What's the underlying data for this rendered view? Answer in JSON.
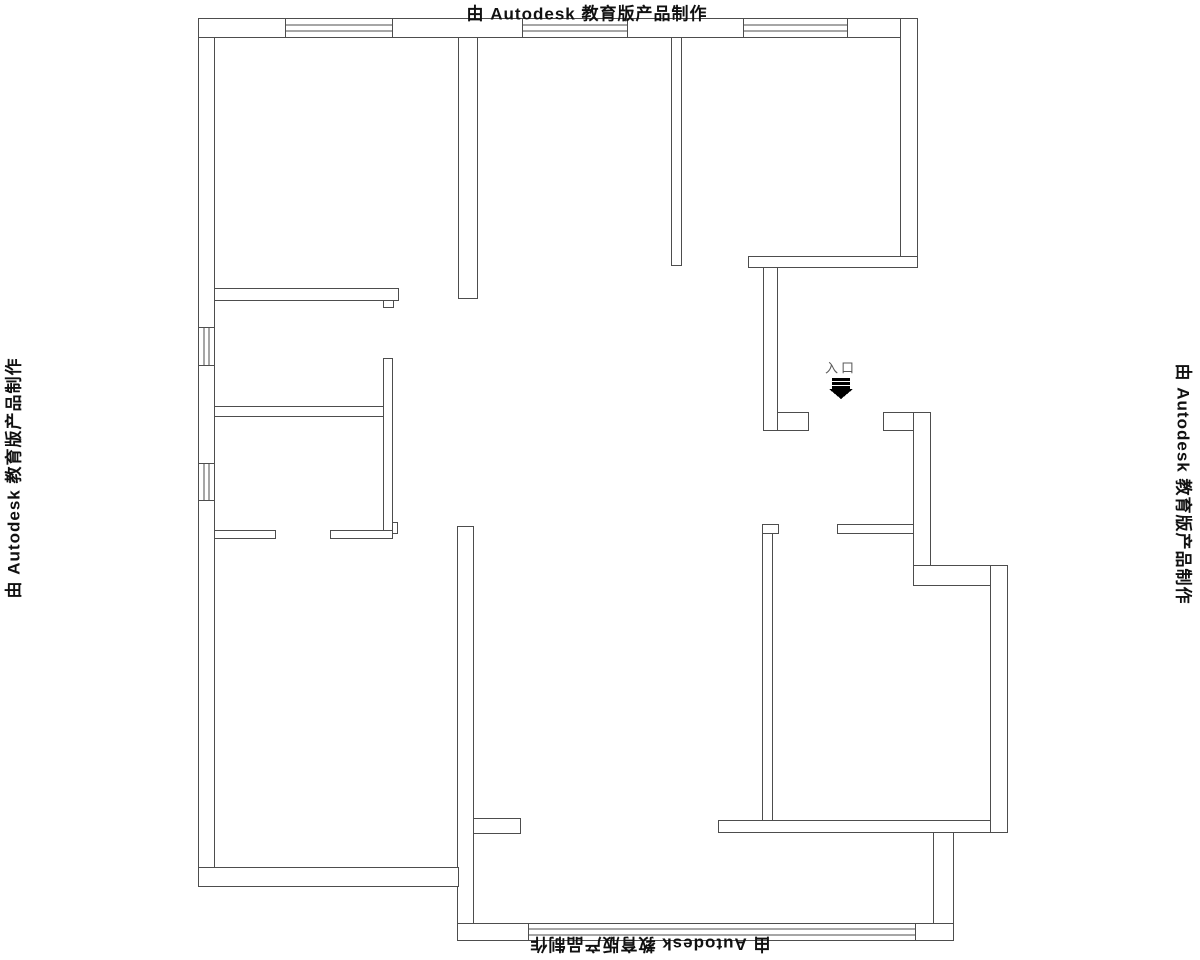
{
  "watermark": {
    "text": "由 Autodesk 教育版产品制作"
  },
  "entrance": {
    "label": "入口"
  },
  "drawing": {
    "line_color": "#4d4d4d",
    "wall_fill": "#ffffff",
    "arrow_color": "#000000",
    "walls": [
      {
        "name": "exterior-left-wall",
        "x": 198,
        "y": 18,
        "w": 16,
        "h": 868
      },
      {
        "name": "exterior-top-wall",
        "x": 198,
        "y": 18,
        "w": 719,
        "h": 19
      },
      {
        "name": "exterior-right-wall-upper",
        "x": 900,
        "y": 18,
        "w": 17,
        "h": 249
      },
      {
        "name": "topright-room-bottom-wall",
        "x": 748,
        "y": 256,
        "w": 169,
        "h": 11
      },
      {
        "name": "porch-left-wall",
        "x": 763,
        "y": 267,
        "w": 14,
        "h": 163
      },
      {
        "name": "porch-left-wall-foot",
        "x": 777,
        "y": 412,
        "w": 31,
        "h": 18
      },
      {
        "name": "porch-right-wall",
        "x": 883,
        "y": 412,
        "w": 47,
        "h": 18
      },
      {
        "name": "exterior-right-wall-mid",
        "x": 913,
        "y": 412,
        "w": 17,
        "h": 153
      },
      {
        "name": "exterior-right-step",
        "x": 913,
        "y": 565,
        "w": 94,
        "h": 20
      },
      {
        "name": "exterior-right-wall-lower",
        "x": 990,
        "y": 565,
        "w": 17,
        "h": 267
      },
      {
        "name": "bottomright-room-bottom-wall",
        "x": 718,
        "y": 820,
        "w": 272,
        "h": 12
      },
      {
        "name": "balcony-right-column",
        "x": 933,
        "y": 832,
        "w": 20,
        "h": 108
      },
      {
        "name": "balcony-left-wall",
        "x": 457,
        "y": 526,
        "w": 16,
        "h": 414
      },
      {
        "name": "balcony-left-stub",
        "x": 473,
        "y": 818,
        "w": 47,
        "h": 15
      },
      {
        "name": "exterior-bottom-wall-left",
        "x": 198,
        "y": 867,
        "w": 260,
        "h": 19
      },
      {
        "name": "balcony-bottom-wall",
        "x": 457,
        "y": 923,
        "w": 496,
        "h": 17
      },
      {
        "name": "topleft-room-right-wall",
        "x": 458,
        "y": 37,
        "w": 19,
        "h": 261
      },
      {
        "name": "topleft-room-bottom-wall",
        "x": 214,
        "y": 288,
        "w": 184,
        "h": 12
      },
      {
        "name": "topleft-room-bottom-notch",
        "x": 383,
        "y": 300,
        "w": 10,
        "h": 7
      },
      {
        "name": "topmid-topright-partition",
        "x": 671,
        "y": 37,
        "w": 10,
        "h": 228
      },
      {
        "name": "left-rooms-divider-wall",
        "x": 214,
        "y": 406,
        "w": 169,
        "h": 10
      },
      {
        "name": "left-vertical-wall",
        "x": 383,
        "y": 358,
        "w": 9,
        "h": 175
      },
      {
        "name": "left-vertical-wall-foot",
        "x": 392,
        "y": 522,
        "w": 5,
        "h": 11
      },
      {
        "name": "left-rooms-bottom-wall-a",
        "x": 214,
        "y": 530,
        "w": 61,
        "h": 8
      },
      {
        "name": "left-rooms-bottom-wall-b",
        "x": 330,
        "y": 530,
        "w": 62,
        "h": 8
      },
      {
        "name": "bottomright-room-top-wall",
        "x": 837,
        "y": 524,
        "w": 76,
        "h": 9
      },
      {
        "name": "bottomright-room-left-wall",
        "x": 762,
        "y": 524,
        "w": 10,
        "h": 296
      },
      {
        "name": "bottomright-room-left-head",
        "x": 762,
        "y": 524,
        "w": 16,
        "h": 9
      }
    ],
    "windows": [
      {
        "name": "window-top-left",
        "x": 285,
        "y": 18,
        "w": 107,
        "h": 19,
        "orient": "h"
      },
      {
        "name": "window-top-middle",
        "x": 522,
        "y": 18,
        "w": 105,
        "h": 19,
        "orient": "h"
      },
      {
        "name": "window-top-right",
        "x": 743,
        "y": 18,
        "w": 104,
        "h": 19,
        "orient": "h"
      },
      {
        "name": "window-left-upper",
        "x": 198,
        "y": 327,
        "w": 16,
        "h": 38,
        "orient": "v"
      },
      {
        "name": "window-left-lower",
        "x": 198,
        "y": 463,
        "w": 16,
        "h": 37,
        "orient": "v"
      },
      {
        "name": "window-balcony",
        "x": 528,
        "y": 923,
        "w": 387,
        "h": 17,
        "orient": "h"
      }
    ],
    "entrance_arrow": {
      "bars": [
        {
          "x": 832,
          "y": 378,
          "w": 18,
          "h": 3
        },
        {
          "x": 832,
          "y": 382,
          "w": 18,
          "h": 3
        },
        {
          "x": 832,
          "y": 386,
          "w": 18,
          "h": 3
        }
      ],
      "triangle": [
        [
          829,
          389
        ],
        [
          853,
          389
        ],
        [
          841,
          399
        ]
      ]
    }
  }
}
